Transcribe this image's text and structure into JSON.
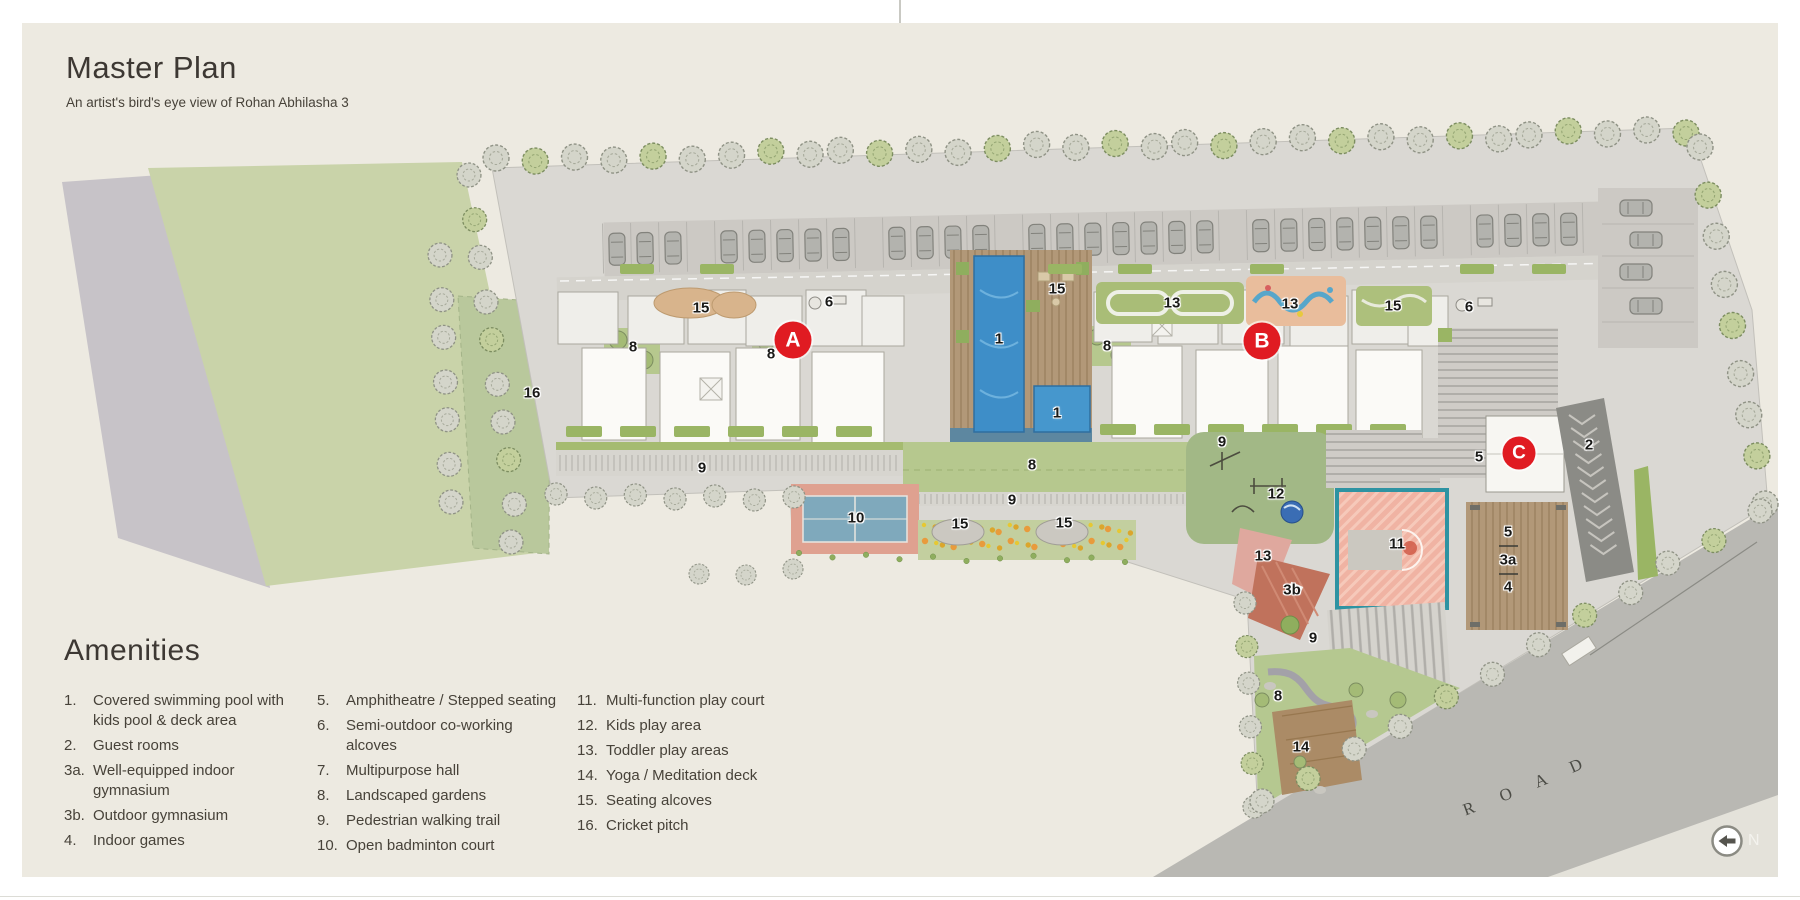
{
  "header": {
    "title": "Master Plan",
    "subtitle": "An artist's bird's eye view of Rohan Abhilasha 3"
  },
  "amenities": {
    "heading": "Amenities",
    "columns": [
      [
        {
          "num": "1.",
          "label": "Covered swimming pool with\nkids pool & deck area"
        },
        {
          "num": "2.",
          "label": "Guest rooms"
        },
        {
          "num": "3a.",
          "label": "Well-equipped indoor gymnasium"
        },
        {
          "num": "3b.",
          "label": "Outdoor gymnasium"
        },
        {
          "num": "4.",
          "label": "Indoor games"
        }
      ],
      [
        {
          "num": "5.",
          "label": "Amphitheatre / Stepped seating"
        },
        {
          "num": "6.",
          "label": "Semi-outdoor co-working alcoves"
        },
        {
          "num": "7.",
          "label": "Multipurpose hall"
        },
        {
          "num": "8.",
          "label": "Landscaped gardens"
        },
        {
          "num": "9.",
          "label": "Pedestrian walking trail"
        },
        {
          "num": "10.",
          "label": "Open badminton court"
        }
      ],
      [
        {
          "num": "11.",
          "label": "Multi-function play court"
        },
        {
          "num": "12.",
          "label": "Kids play area"
        },
        {
          "num": "13.",
          "label": "Toddler play areas"
        },
        {
          "num": "14.",
          "label": "Yoga / Meditation deck"
        },
        {
          "num": "15.",
          "label": "Seating alcoves"
        },
        {
          "num": "16.",
          "label": "Cricket pitch"
        }
      ]
    ]
  },
  "plan": {
    "building_markers": [
      {
        "id": "A",
        "x": 793,
        "y": 340
      },
      {
        "id": "B",
        "x": 1262,
        "y": 341
      },
      {
        "id": "C",
        "x": 1519,
        "y": 453
      }
    ],
    "amenity_labels": [
      {
        "t": "16",
        "x": 532,
        "y": 393
      },
      {
        "t": "15",
        "x": 701,
        "y": 308
      },
      {
        "t": "6",
        "x": 829,
        "y": 302
      },
      {
        "t": "8",
        "x": 633,
        "y": 347
      },
      {
        "t": "8",
        "x": 771,
        "y": 354
      },
      {
        "t": "9",
        "x": 702,
        "y": 468
      },
      {
        "t": "15",
        "x": 1057,
        "y": 289
      },
      {
        "t": "1",
        "x": 999,
        "y": 339
      },
      {
        "t": "1",
        "x": 1057,
        "y": 413
      },
      {
        "t": "8",
        "x": 1107,
        "y": 346
      },
      {
        "t": "13",
        "x": 1172,
        "y": 303
      },
      {
        "t": "13",
        "x": 1290,
        "y": 304
      },
      {
        "t": "15",
        "x": 1393,
        "y": 306
      },
      {
        "t": "6",
        "x": 1469,
        "y": 307
      },
      {
        "t": "9",
        "x": 1222,
        "y": 442
      },
      {
        "t": "5",
        "x": 1479,
        "y": 457
      },
      {
        "t": "2",
        "x": 1589,
        "y": 445
      },
      {
        "t": "5",
        "x": 1508,
        "y": 532
      },
      {
        "t": "3a",
        "x": 1508,
        "y": 560
      },
      {
        "t": "4",
        "x": 1508,
        "y": 587
      },
      {
        "t": "10",
        "x": 856,
        "y": 518
      },
      {
        "t": "8",
        "x": 1032,
        "y": 465
      },
      {
        "t": "9",
        "x": 1012,
        "y": 500
      },
      {
        "t": "15",
        "x": 960,
        "y": 524
      },
      {
        "t": "15",
        "x": 1064,
        "y": 523
      },
      {
        "t": "12",
        "x": 1276,
        "y": 494
      },
      {
        "t": "13",
        "x": 1263,
        "y": 556
      },
      {
        "t": "3b",
        "x": 1292,
        "y": 590
      },
      {
        "t": "9",
        "x": 1313,
        "y": 638
      },
      {
        "t": "8",
        "x": 1278,
        "y": 696
      },
      {
        "t": "14",
        "x": 1301,
        "y": 747
      },
      {
        "t": "11",
        "x": 1397,
        "y": 544
      }
    ],
    "road_letters": [
      {
        "ch": "R",
        "x": 1469,
        "y": 809,
        "rot": -20
      },
      {
        "ch": "O",
        "x": 1506,
        "y": 795,
        "rot": -21
      },
      {
        "ch": "A",
        "x": 1541,
        "y": 781,
        "rot": -22
      },
      {
        "ch": "D",
        "x": 1576,
        "y": 766,
        "rot": -23
      }
    ],
    "north": {
      "label": "N"
    }
  },
  "colors": {
    "marker_red": "#e01b22",
    "pool_blue": "#3e8ec8",
    "panel_cream": "#edeae1",
    "site_gray": "#dad8d3",
    "field_green": "#c9d3a9",
    "road_gray": "#b9b8b3"
  }
}
